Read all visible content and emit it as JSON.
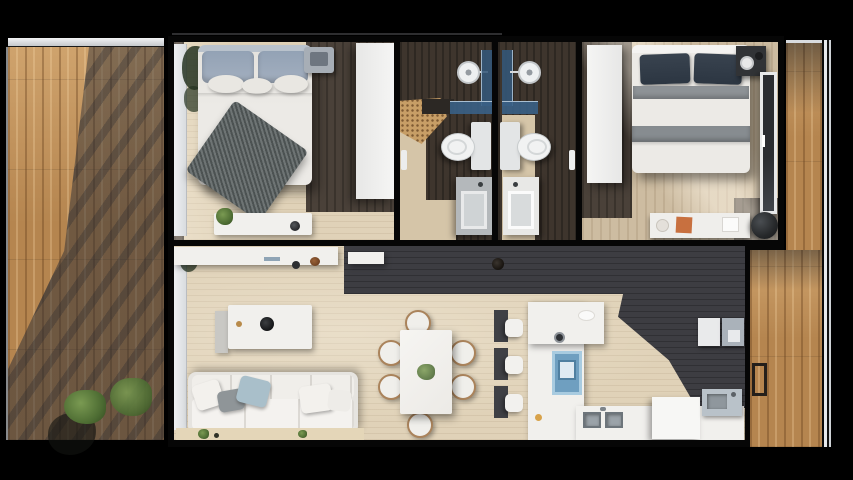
{
  "scene": {
    "type": "apartment-floor-plan-3d-render",
    "description": "Top-down photorealistic 3D floor plan of a two-bedroom, two-bathroom apartment with an open living, dining and kitchen area and wooden terrace decks on the left and right sides",
    "background": "#000000"
  },
  "palette": {
    "page-bg": "#000000",
    "wall": "#060606",
    "deck-wood": "#b5854f",
    "deck-light": "#cfa36d",
    "deck-dark": "#7e5a36",
    "floor-dark": "#4a4139",
    "floor-beige": "#e0d2b8",
    "floor-lightwood": "#cdbca1",
    "bath-floor": "#3e352d",
    "bath-path": "#d5c5a8",
    "mosaic": "#c79e66",
    "charcoal": "#3d3d42",
    "white-furn": "#f1f0ed",
    "duvet": "#eceae6",
    "pillow-blue": "#a3afbf",
    "pillow-navy": "#2c3642",
    "throw-gray": "#596060",
    "blanket-gray": "#8d9296",
    "glass-blue": "#3f6a94",
    "rug-blue": "#6f9fc0",
    "sofa-pillow-blue": "#a9bfca",
    "plant-green": "#5d7c3e",
    "wood-chair": "#aa835b",
    "steel": "#9ba3a9",
    "pouf-dark": "#222426",
    "accent-orange": "#c8703f"
  },
  "rooms": {
    "left_terrace": {
      "label": "left terrace deck",
      "features": [
        "wood decking",
        "building shadow",
        "white railing",
        "planter shrubs"
      ]
    },
    "bedroom1": {
      "label": "bedroom one",
      "furniture": [
        "double bed with knit throw",
        "blue-gray pillows",
        "wardrobe",
        "bench with plant and tray",
        "laptop tray",
        "terrace door with curtain"
      ]
    },
    "bathroom1": {
      "label": "bathroom one",
      "furniture": [
        "walk-in shower",
        "rain shower head",
        "blue glass screen",
        "mosaic tile floor",
        "toilet",
        "vanity sink",
        "towel rail"
      ]
    },
    "bathroom2": {
      "label": "bathroom two",
      "furniture": [
        "walk-in shower",
        "rain shower head",
        "blue glass screen",
        "toilet",
        "vanity sink",
        "towel rail"
      ]
    },
    "bedroom2": {
      "label": "bedroom two",
      "furniture": [
        "double bed with navy pillows",
        "gray blanket bands",
        "wardrobe",
        "dark nightstand with dish",
        "glass terrace door",
        "desk with papers",
        "dark pouf"
      ]
    },
    "living": {
      "label": "open plan living, dining and kitchen",
      "furniture": [
        "tv console",
        "side shelf",
        "ceiling light",
        "coffee table with tray",
        "white sofa with cushions",
        "balcony planter strip",
        "dining table for six",
        "kitchen island with stools",
        "blue island mat",
        "counter with double sink",
        "appliance block",
        "steel sink unit",
        "wall cabinets"
      ]
    },
    "right_terrace": {
      "label": "right terrace deck",
      "features": [
        "wood decking",
        "white railing",
        "access frame"
      ]
    }
  }
}
